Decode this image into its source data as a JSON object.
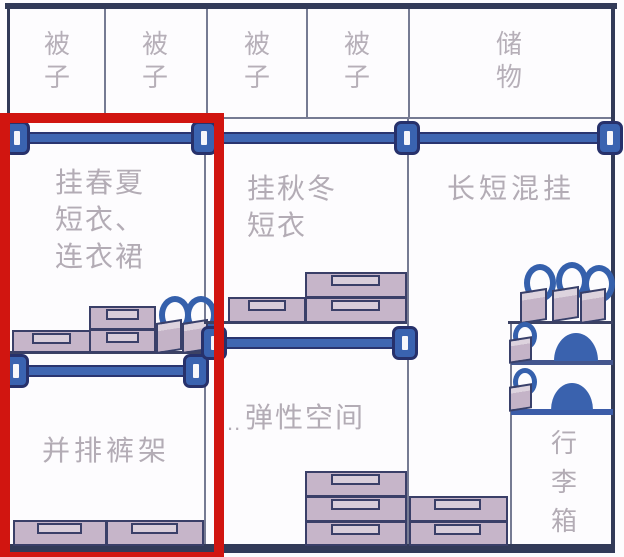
{
  "diagram_title": "wardrobe-layout",
  "palette": {
    "background": "#fdfcfe",
    "structure_navy": "#323a58",
    "divider_gray": "#767b93",
    "rod_blue": "#4067b2",
    "bracket_blue": "#3a63b0",
    "box_fill": "#c6b5c9",
    "box_outline": "#3a3f68",
    "bag_handle_blue": "#3560ac",
    "dome_blue": "#3a62ae",
    "text_gray": "#b3acb5",
    "highlight_red": "#d11510"
  },
  "top_row": {
    "compartments": [
      {
        "label": "被\n子"
      },
      {
        "label": "被\n子"
      },
      {
        "label": "被\n子"
      },
      {
        "label": "被\n子"
      },
      {
        "label": "储\n物"
      }
    ]
  },
  "sections": {
    "spring_summer": {
      "label": "挂春夏\n短衣、\n连衣裙"
    },
    "pants_rack": {
      "label": "并排裤架"
    },
    "autumn_winter": {
      "label": "挂秋冬\n短衣"
    },
    "flexible": {
      "prefix": "..",
      "label": "弹性空间"
    },
    "mixed_hang": {
      "label": "长短混挂"
    },
    "luggage": {
      "label": "行\n李\n箱"
    }
  }
}
